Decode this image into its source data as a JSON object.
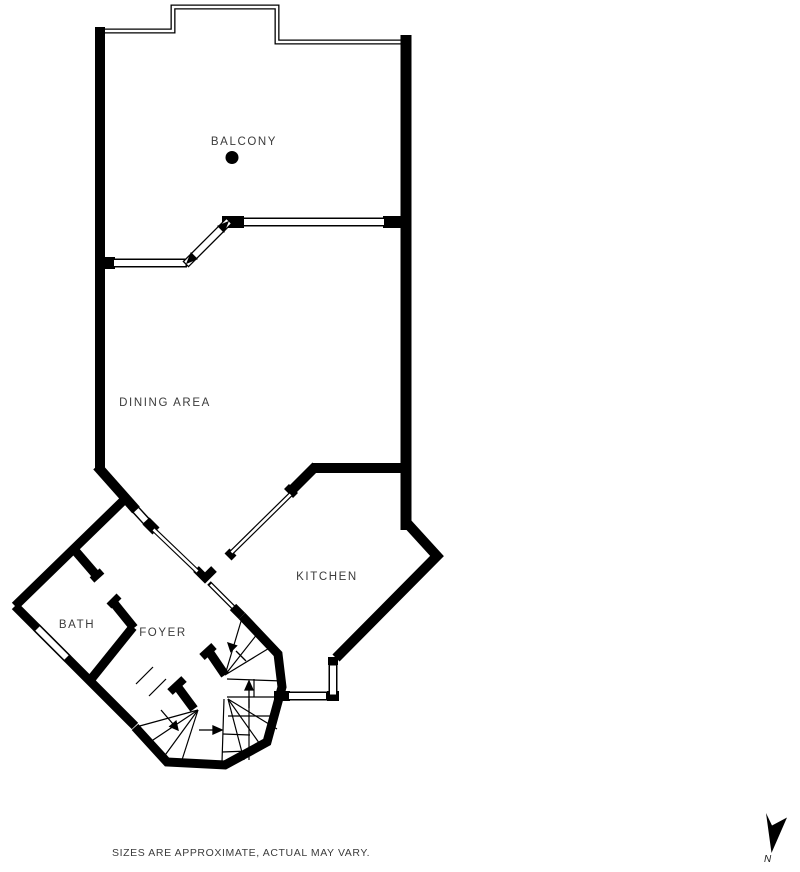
{
  "rooms": [
    {
      "label": "BALCONY"
    },
    {
      "label": "DINING AREA"
    },
    {
      "label": "KITCHEN"
    },
    {
      "label": "FOYER"
    },
    {
      "label": "BATH"
    }
  ],
  "footer": {
    "disclaimer": "SIZES ARE APPROXIMATE, ACTUAL MAY VARY."
  },
  "compass": {
    "label": "N"
  },
  "colors": {
    "wall": "#000000",
    "label_text": "#3b3b3b",
    "background": "#ffffff"
  }
}
